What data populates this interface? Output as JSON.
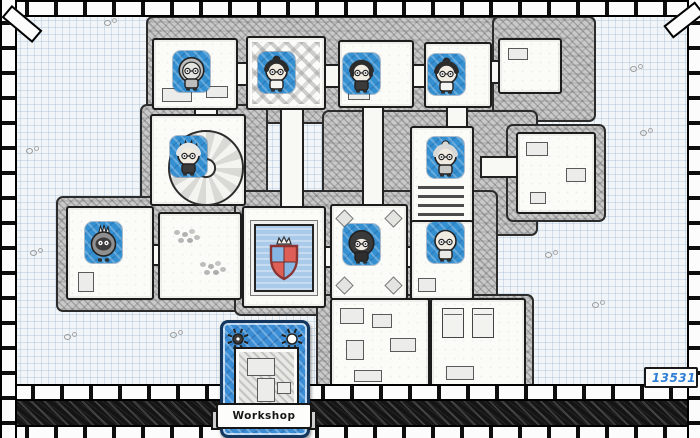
{
  "screen": {
    "name": "guild-dungeon-map"
  },
  "hud": {
    "workshop_card": {
      "label": "Workshop",
      "icons": [
        "sun-icon-dark",
        "sun-icon-light"
      ]
    },
    "resource_counter": {
      "value": "13531",
      "icon": "sun-icon"
    }
  },
  "map": {
    "crest": {
      "name": "guild-crest-shield",
      "quarters": [
        "blue",
        "red",
        "red",
        "blue"
      ],
      "has_crown": true
    },
    "character_tiles": [
      {
        "id": 1,
        "x": 173,
        "y": 51,
        "variant": "hood-grey",
        "description": "dungeoneer in grey hood"
      },
      {
        "id": 2,
        "x": 258,
        "y": 52,
        "variant": "bun-dark-white-robe",
        "description": "dark bun hair, white robe"
      },
      {
        "id": 3,
        "x": 343,
        "y": 53,
        "variant": "bob-dark",
        "description": "dark bob haircut dungeoneer"
      },
      {
        "id": 4,
        "x": 428,
        "y": 54,
        "variant": "bun-dark-white-robe",
        "description": "dark bun hair, white robe"
      },
      {
        "id": 5,
        "x": 170,
        "y": 136,
        "variant": "spiky-white",
        "description": "white spiky hair, by spiral stair"
      },
      {
        "id": 6,
        "x": 427,
        "y": 137,
        "variant": "bun-grey",
        "description": "grey-bunned granny dungeoneer"
      },
      {
        "id": 7,
        "x": 85,
        "y": 222,
        "variant": "bird-mohawk",
        "description": "grey bird creature with white mohawk"
      },
      {
        "id": 8,
        "x": 343,
        "y": 224,
        "variant": "hood-dark",
        "description": "dark hooded dungeoneer"
      },
      {
        "id": 9,
        "x": 427,
        "y": 222,
        "variant": "bald-goatee",
        "description": "bald dungeoneer with goatee"
      }
    ]
  },
  "colors": {
    "paper": "#f2f5f7",
    "tile_blue": "#3590d2",
    "card_blue": "#3b8ed6",
    "counter_text": "#2f7fd6",
    "crest_red": "#dd5f55",
    "crest_blue": "#86b7e4",
    "crest_border": "#8a3434",
    "crest_plaque": "#a9cae9"
  }
}
